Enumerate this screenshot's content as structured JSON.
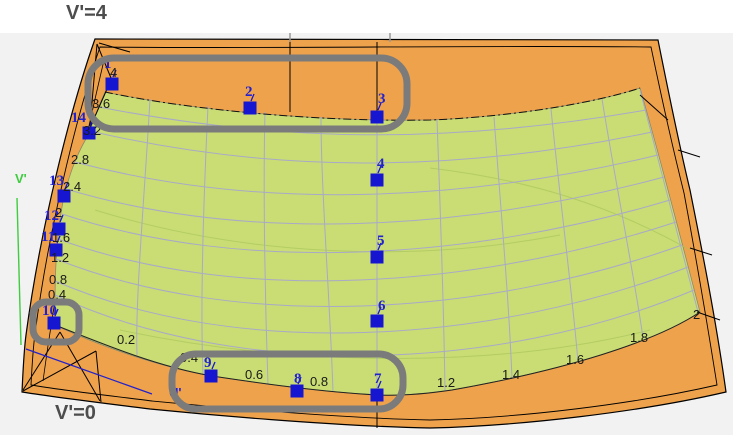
{
  "annotations": {
    "top_label": "V'=4",
    "bottom_label": "V'=0"
  },
  "axes": {
    "v_label": "V'",
    "u_label": "U'"
  },
  "colors": {
    "outer_surface": "#EFA24C",
    "inner_surface": "#C9DD74",
    "grid": "#A9A9C8",
    "outline": "#000000",
    "viewport_bg": "#F2F2F2",
    "highlight": "#7B7B7B",
    "point": "#1616D0",
    "point_label": "#2121CE",
    "iso_label": "#1A1A1A",
    "axis_v": "#3FCC3F",
    "axis_u": "#2222CC",
    "title": "#4D4D4D"
  },
  "points": [
    {
      "label": "1",
      "x": 112,
      "y": 84,
      "lx": 104,
      "ly": 57
    },
    {
      "label": "2",
      "x": 250,
      "y": 108,
      "lx": 245,
      "ly": 85
    },
    {
      "label": "3",
      "x": 377,
      "y": 117,
      "lx": 378,
      "ly": 92
    },
    {
      "label": "4",
      "x": 377,
      "y": 180,
      "lx": 377,
      "ly": 157
    },
    {
      "label": "5",
      "x": 377,
      "y": 257,
      "lx": 377,
      "ly": 234
    },
    {
      "label": "6",
      "x": 377,
      "y": 321,
      "lx": 378,
      "ly": 299
    },
    {
      "label": "7",
      "x": 377,
      "y": 395,
      "lx": 374,
      "ly": 372
    },
    {
      "label": "8",
      "x": 297,
      "y": 391,
      "lx": 294,
      "ly": 372
    },
    {
      "label": "9",
      "x": 211,
      "y": 376,
      "lx": 204,
      "ly": 356
    },
    {
      "label": "10",
      "x": 54,
      "y": 323,
      "lx": 42,
      "ly": 304
    },
    {
      "label": "11",
      "x": 56,
      "y": 250,
      "lx": 41,
      "ly": 230
    },
    {
      "label": "12",
      "x": 59,
      "y": 229,
      "lx": 44,
      "ly": 209
    },
    {
      "label": "13",
      "x": 64,
      "y": 196,
      "lx": 49,
      "ly": 174
    },
    {
      "label": "14",
      "x": 89,
      "y": 133,
      "lx": 71,
      "ly": 111
    }
  ],
  "iso_left": [
    {
      "t": "4",
      "x": 110,
      "y": 66
    },
    {
      "t": "3.6",
      "x": 92,
      "y": 97
    },
    {
      "t": "3.2",
      "x": 83,
      "y": 124
    },
    {
      "t": "2.8",
      "x": 71,
      "y": 153
    },
    {
      "t": "2.4",
      "x": 63,
      "y": 180
    },
    {
      "t": "2",
      "x": 55,
      "y": 206
    },
    {
      "t": "1.6",
      "x": 52,
      "y": 231
    },
    {
      "t": "1.2",
      "x": 51,
      "y": 251
    },
    {
      "t": "0.8",
      "x": 49,
      "y": 273
    },
    {
      "t": "0.4",
      "x": 48,
      "y": 288
    }
  ],
  "iso_bottom": [
    {
      "t": "0.2",
      "x": 117,
      "y": 333
    },
    {
      "t": "0.4",
      "x": 180,
      "y": 351
    },
    {
      "t": "0.6",
      "x": 245,
      "y": 368
    },
    {
      "t": "0.8",
      "x": 310,
      "y": 375
    },
    {
      "t": "1.2",
      "x": 437,
      "y": 376
    },
    {
      "t": "1.4",
      "x": 502,
      "y": 368
    },
    {
      "t": "1.6",
      "x": 566,
      "y": 353
    },
    {
      "t": "1.8",
      "x": 630,
      "y": 331
    },
    {
      "t": "2",
      "x": 693,
      "y": 308
    }
  ],
  "highlights": [
    {
      "x": 88,
      "y": 58,
      "w": 319,
      "h": 71,
      "r": 26
    },
    {
      "x": 33,
      "y": 302,
      "w": 46,
      "h": 40,
      "r": 13
    },
    {
      "x": 172,
      "y": 354,
      "w": 231,
      "h": 55,
      "r": 24
    }
  ],
  "axis_label_pos": {
    "v": {
      "x": 15,
      "y": 172
    },
    "u": {
      "x": 169,
      "y": 386
    }
  }
}
